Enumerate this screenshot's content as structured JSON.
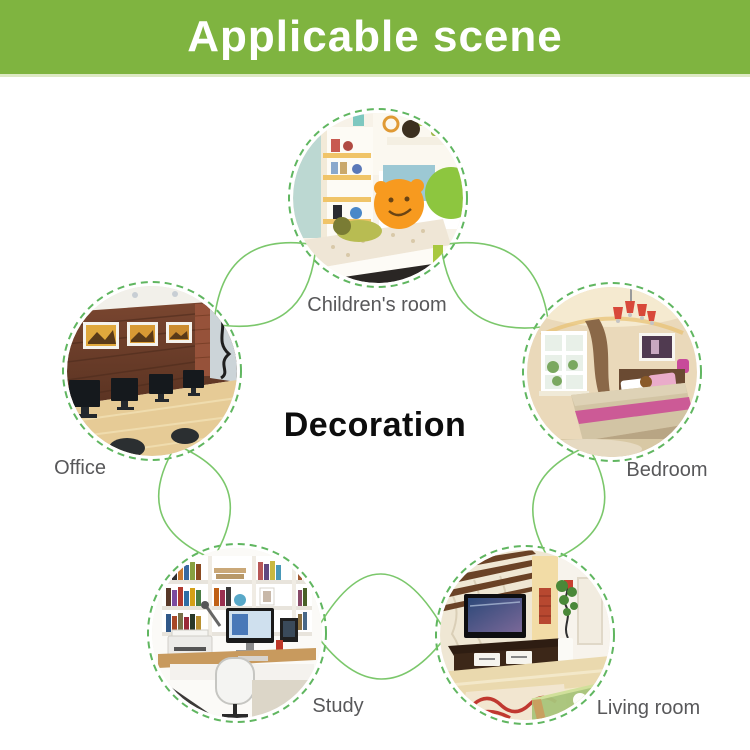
{
  "header": {
    "title": "Applicable scene"
  },
  "center_label": "Decoration",
  "colors": {
    "banner_green": "#7fb440",
    "ring_dash_green": "#4fae4f",
    "connector_green": "#74c463",
    "label_gray": "#58585a",
    "center_text": "#0d0d0d"
  },
  "diagram": {
    "shape": "five photo circles linked by petal-shaped green connectors",
    "nodes": [
      {
        "id": "children-room",
        "label": "Children's room"
      },
      {
        "id": "office",
        "label": "Office"
      },
      {
        "id": "bedroom",
        "label": "Bedroom"
      },
      {
        "id": "study",
        "label": "Study"
      },
      {
        "id": "living-room",
        "label": "Living room"
      }
    ]
  }
}
